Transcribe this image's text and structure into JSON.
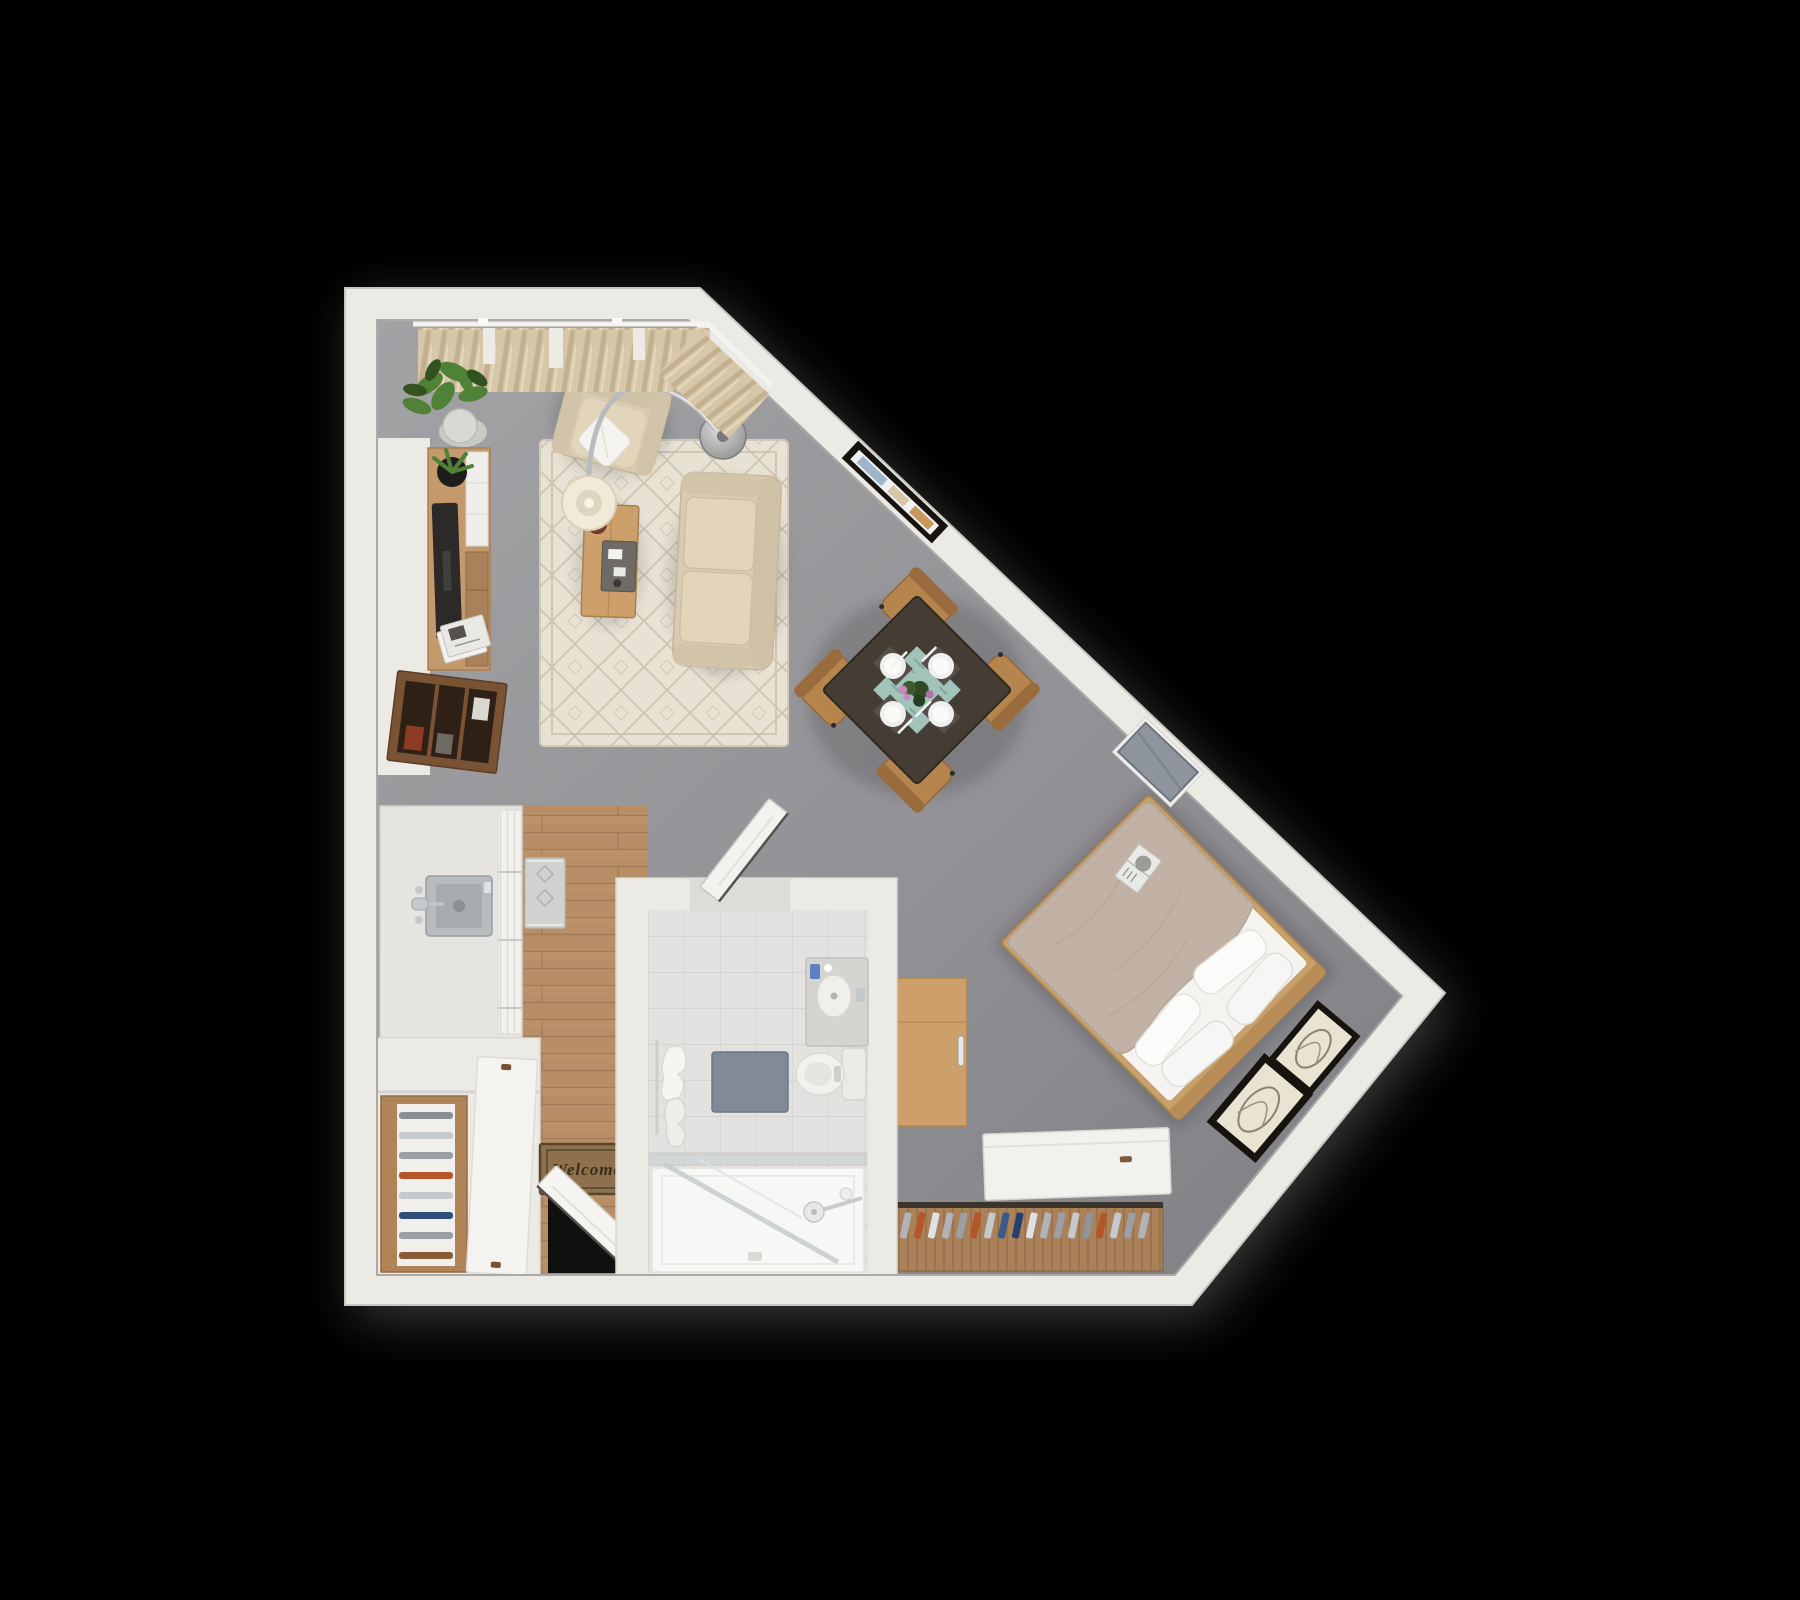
{
  "scene": {
    "title": "Studio apartment 3D top-down floor plan",
    "background": "#000000"
  },
  "entry": {
    "mat_text": "Welcome"
  },
  "colors": {
    "wall": "#eceae5",
    "wall_edge": "#cfcdc7",
    "carpet": "#97979b",
    "wood_floor": "#b88e67",
    "tile": "#e3e2e0",
    "rug": "#e8e2d5",
    "sofa": "#d8cbb1",
    "cushion": "#e2d5ba",
    "duvet": "#c2b2a6",
    "sheet": "#f4f3f0",
    "bed_frame": "#c9a06a",
    "oak": "#cda06b",
    "console_wood": "#c49a6c",
    "walnut": "#7a5335",
    "dining_table": "#453c34",
    "chair_wood": "#b5854d",
    "runner_teal": "#a8cac1",
    "flower_pink": "#c987bd",
    "plant_green": "#4f8136",
    "lamp_shade": "#f1ead8",
    "chrome": "#b9bcbe",
    "mat_brown": "#8d714c",
    "bath_mat": "#7c8795",
    "towel": "#f6f5f2",
    "curtain": "#d8c8a9",
    "tv_black": "#2b2a28",
    "frame_black": "#17130f",
    "art_paper": "#e9e3d2",
    "clothes_rust": "#b4552a",
    "clothes_blue": "#3a5a8c",
    "clothes_gray": "#b0b4b8"
  },
  "rooms": [
    {
      "id": "living-area",
      "label": "Living area"
    },
    {
      "id": "dining-area",
      "label": "Dining area"
    },
    {
      "id": "sleeping-area",
      "label": "Sleeping area"
    },
    {
      "id": "kitchen",
      "label": "Kitchen"
    },
    {
      "id": "bathroom",
      "label": "Bathroom"
    },
    {
      "id": "entry",
      "label": "Entry"
    },
    {
      "id": "closet",
      "label": "Closet"
    }
  ],
  "furniture": [
    {
      "id": "curtains",
      "label": "Curtains on rod"
    },
    {
      "id": "potted-plant",
      "label": "Potted plant"
    },
    {
      "id": "armchair",
      "label": "Armchair with throw pillow"
    },
    {
      "id": "arc-floor-lamp",
      "label": "Arc floor lamp"
    },
    {
      "id": "area-rug",
      "label": "Patterned area rug"
    },
    {
      "id": "coffee-table",
      "label": "Coffee table with tray and bowl"
    },
    {
      "id": "sofa",
      "label": "Two-seat sofa"
    },
    {
      "id": "tv-console",
      "label": "TV console with TV, plant and magazines"
    },
    {
      "id": "media-cabinet",
      "label": "Open media cabinet"
    },
    {
      "id": "wall-art",
      "label": "Framed wall art"
    },
    {
      "id": "dining-table",
      "label": "Dining table with 4 place settings"
    },
    {
      "id": "dining-chairs",
      "label": "4 dining chairs"
    },
    {
      "id": "wall-panel",
      "label": "Wall-mounted panel"
    },
    {
      "id": "bed",
      "label": "Double bed with duvet and 4 pillows"
    },
    {
      "id": "bed-book",
      "label": "Open book on bed"
    },
    {
      "id": "leaning-frames",
      "label": "2 leaning art frames"
    },
    {
      "id": "desk",
      "label": "Desk"
    },
    {
      "id": "wardrobe",
      "label": "Sliding-door wardrobe"
    },
    {
      "id": "clothes-rack",
      "label": "Clothes rack with hangers"
    },
    {
      "id": "kitchen-counter",
      "label": "Kitchen counter with sink"
    },
    {
      "id": "kitchen-rug",
      "label": "Kitchen runner rug"
    },
    {
      "id": "shoe-shelf",
      "label": "Slatted shoe shelf"
    },
    {
      "id": "welcome-mat",
      "label": "Welcome door mat"
    },
    {
      "id": "front-door",
      "label": "Open front door"
    },
    {
      "id": "bathroom-door",
      "label": "Open bathroom door"
    },
    {
      "id": "vanity",
      "label": "Bathroom vanity with sink"
    },
    {
      "id": "toilet",
      "label": "Toilet"
    },
    {
      "id": "bath-mat",
      "label": "Bath mat"
    },
    {
      "id": "towels",
      "label": "Hanging towels"
    },
    {
      "id": "shower",
      "label": "Walk-in shower with glass partition"
    }
  ]
}
